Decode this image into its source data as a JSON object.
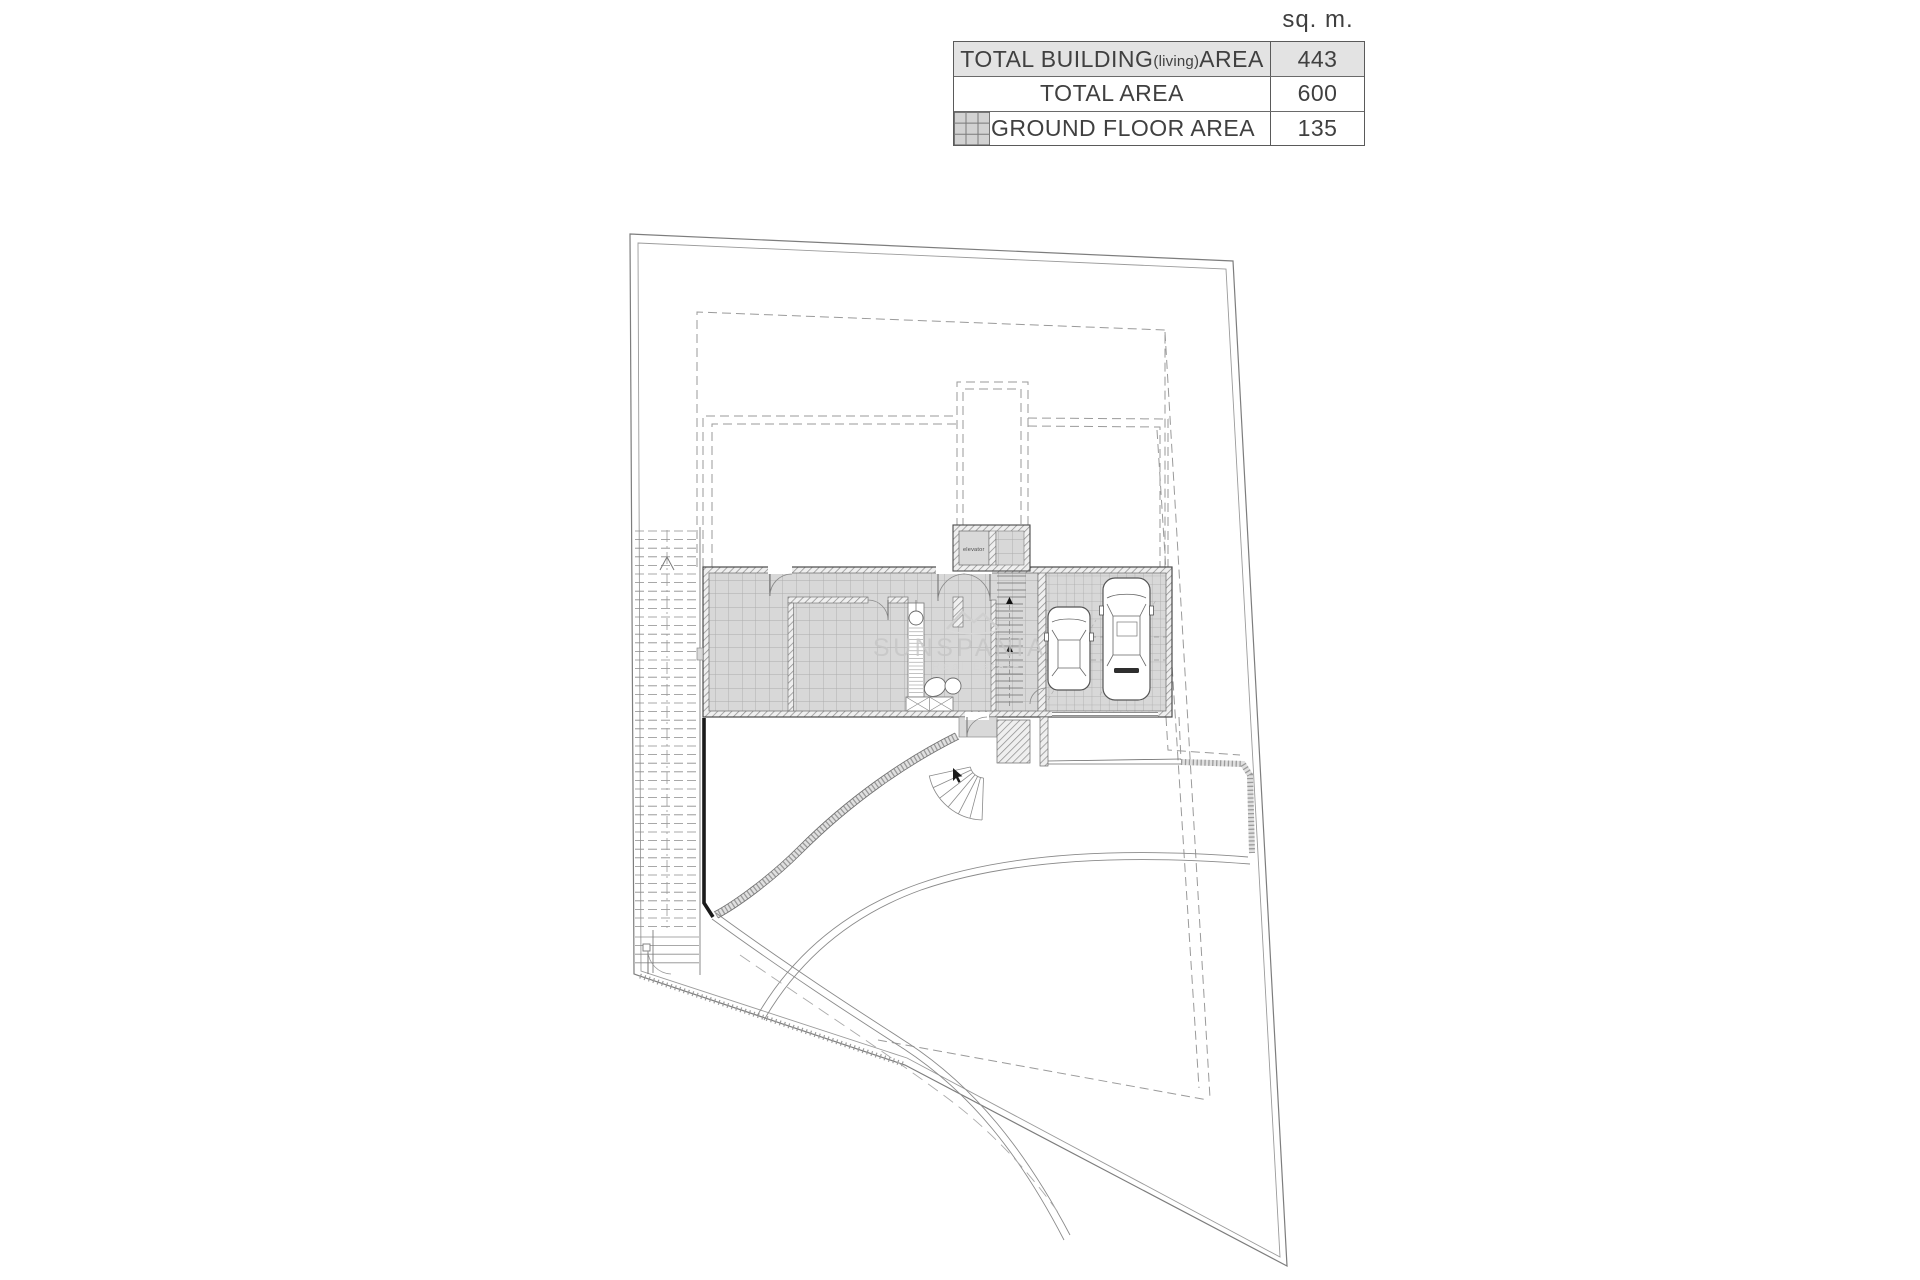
{
  "unit_header": "sq. m.",
  "area_table": {
    "swatch_icon": "tile-hatch-swatch",
    "rows": [
      {
        "label_main": "TOTAL BUILDING",
        "label_sub": "(living)",
        "label_tail": " AREA",
        "value": "443"
      },
      {
        "label_main": "TOTAL AREA",
        "value": "600"
      },
      {
        "label_main": "GROUND FLOOR AREA",
        "value": "135"
      }
    ]
  },
  "plan": {
    "elevator_label": "elevator",
    "watermark_title": "SUNSPANIA",
    "watermark_subtitle": "Real Estate"
  },
  "colors": {
    "table_row_shade": "#e3e3e3",
    "drawing_line": "#8a8a8a",
    "building_tile_fill": "#d8d8d8",
    "wall_hatch_line": "#929292",
    "watermark_gray": "#c6c6c6",
    "black_wall": "#1a1a1a"
  }
}
